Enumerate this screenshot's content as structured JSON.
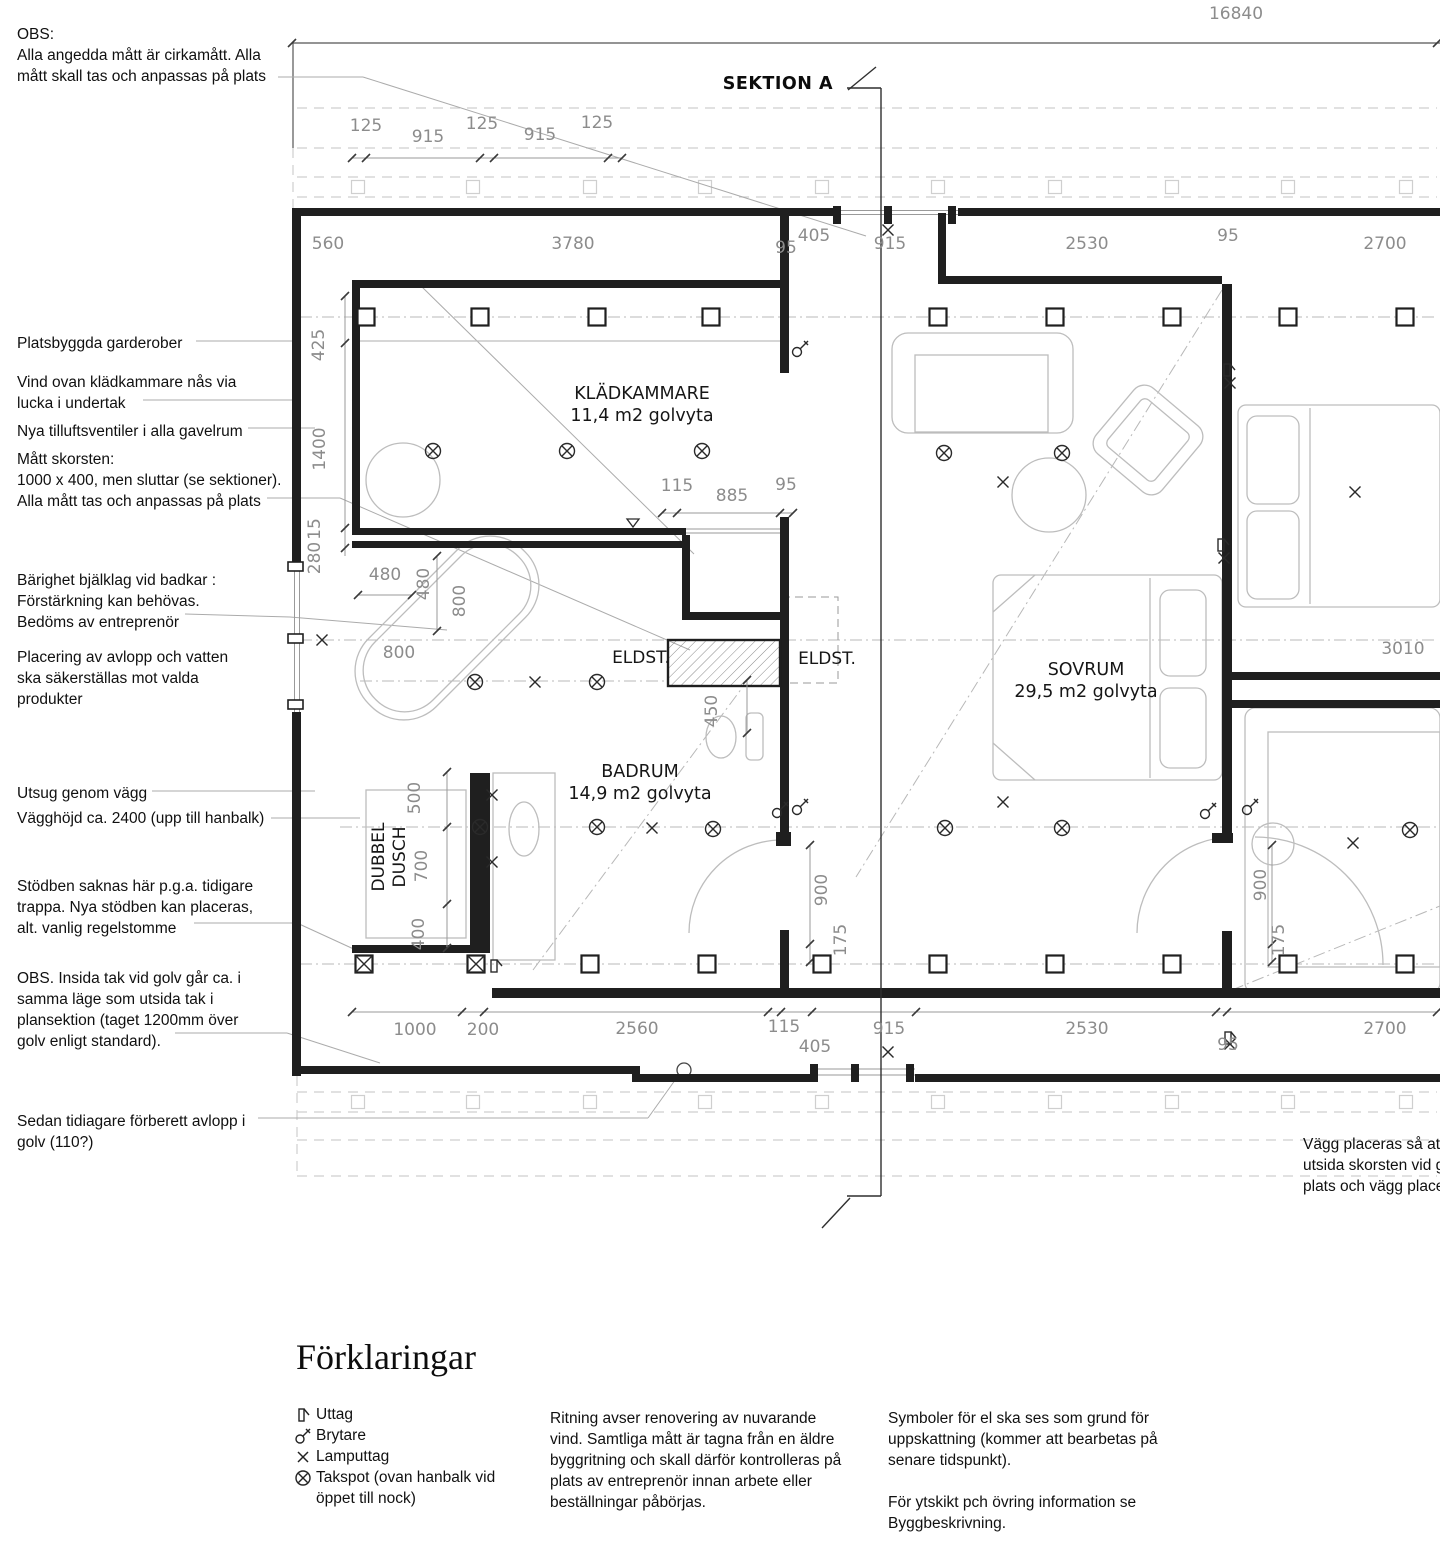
{
  "section": {
    "label": "SEKTION A"
  },
  "rooms": [
    {
      "name": "KLÄDKAMMARE",
      "area": "11,4 m2 golvyta",
      "x": 642,
      "y": 399
    },
    {
      "name": "BADRUM",
      "area": "14,9 m2 golvyta",
      "x": 640,
      "y": 777
    },
    {
      "name": "SOVRUM",
      "area": "29,5 m2 golvyta",
      "x": 1086,
      "y": 675
    }
  ],
  "plan_labels": [
    {
      "text": "ELDST.",
      "x": 641,
      "y": 663
    },
    {
      "text": "ELDST.",
      "x": 827,
      "y": 664
    },
    {
      "text": "DUBBEL",
      "x": 384,
      "y": 857,
      "rot": -90
    },
    {
      "text": "DUSCH",
      "x": 405,
      "y": 857,
      "rot": -90
    }
  ],
  "dimensions": [
    {
      "t": "16840",
      "x": 1236,
      "y": 19
    },
    {
      "t": "125",
      "x": 366,
      "y": 131
    },
    {
      "t": "915",
      "x": 428,
      "y": 142
    },
    {
      "t": "125",
      "x": 482,
      "y": 129
    },
    {
      "t": "915",
      "x": 540,
      "y": 140
    },
    {
      "t": "125",
      "x": 597,
      "y": 128
    },
    {
      "t": "560",
      "x": 328,
      "y": 249
    },
    {
      "t": "3780",
      "x": 573,
      "y": 249
    },
    {
      "t": "95",
      "x": 786,
      "y": 253
    },
    {
      "t": "405",
      "x": 814,
      "y": 241
    },
    {
      "t": "915",
      "x": 890,
      "y": 249
    },
    {
      "t": "2530",
      "x": 1087,
      "y": 249
    },
    {
      "t": "95",
      "x": 1228,
      "y": 241
    },
    {
      "t": "2700",
      "x": 1385,
      "y": 249
    },
    {
      "t": "425",
      "x": 324,
      "y": 345,
      "rot": -90
    },
    {
      "t": "1400",
      "x": 325,
      "y": 449,
      "rot": -90
    },
    {
      "t": "15",
      "x": 320,
      "y": 529,
      "rot": -90
    },
    {
      "t": "280",
      "x": 320,
      "y": 558,
      "rot": -90
    },
    {
      "t": "115",
      "x": 677,
      "y": 491
    },
    {
      "t": "885",
      "x": 732,
      "y": 501
    },
    {
      "t": "95",
      "x": 786,
      "y": 490
    },
    {
      "t": "480",
      "x": 385,
      "y": 580
    },
    {
      "t": "480",
      "x": 429,
      "y": 584,
      "rot": -90
    },
    {
      "t": "800",
      "x": 465,
      "y": 601,
      "rot": -90
    },
    {
      "t": "800",
      "x": 399,
      "y": 658
    },
    {
      "t": "500",
      "x": 420,
      "y": 798,
      "rot": -90
    },
    {
      "t": "700",
      "x": 427,
      "y": 866,
      "rot": -90
    },
    {
      "t": "400",
      "x": 424,
      "y": 934,
      "rot": -90
    },
    {
      "t": "450",
      "x": 717,
      "y": 711,
      "rot": -90
    },
    {
      "t": "900",
      "x": 827,
      "y": 890,
      "rot": -90
    },
    {
      "t": "175",
      "x": 846,
      "y": 940,
      "rot": -90
    },
    {
      "t": "900",
      "x": 1266,
      "y": 885,
      "rot": -90
    },
    {
      "t": "175",
      "x": 1284,
      "y": 940,
      "rot": -90
    },
    {
      "t": "3010",
      "x": 1403,
      "y": 654
    },
    {
      "t": "1000",
      "x": 415,
      "y": 1035
    },
    {
      "t": "200",
      "x": 483,
      "y": 1035
    },
    {
      "t": "2560",
      "x": 637,
      "y": 1034
    },
    {
      "t": "115",
      "x": 784,
      "y": 1032
    },
    {
      "t": "405",
      "x": 815,
      "y": 1052
    },
    {
      "t": "915",
      "x": 889,
      "y": 1034
    },
    {
      "t": "2530",
      "x": 1087,
      "y": 1034
    },
    {
      "t": "95",
      "x": 1228,
      "y": 1050
    },
    {
      "t": "2700",
      "x": 1385,
      "y": 1034
    }
  ],
  "annotations_left": [
    {
      "x": 17,
      "y": 24,
      "lines": [
        "OBS:",
        "Alla angedda mått är cirkamått. Alla",
        "mått skall tas och anpassas på plats"
      ]
    },
    {
      "x": 17,
      "y": 333,
      "lines": [
        "Platsbyggda garderober"
      ]
    },
    {
      "x": 17,
      "y": 372,
      "lines": [
        "Vind ovan klädkammare nås via",
        "lucka i undertak"
      ]
    },
    {
      "x": 17,
      "y": 421,
      "lines": [
        "Nya tilluftsventiler i alla gavelrum"
      ]
    },
    {
      "x": 17,
      "y": 449,
      "lines": [
        "Mått skorsten:",
        "1000 x 400, men sluttar (se sektioner).",
        "Alla mått tas och anpassas på plats"
      ]
    },
    {
      "x": 17,
      "y": 570,
      "lines": [
        "Bärighet bjälklag vid badkar :",
        "Förstärkning kan behövas.",
        "Bedöms av entreprenör"
      ]
    },
    {
      "x": 17,
      "y": 647,
      "lines": [
        "Placering av avlopp och vatten",
        "ska säkerställas mot valda",
        "produkter"
      ]
    },
    {
      "x": 17,
      "y": 783,
      "lines": [
        "Utsug genom vägg"
      ]
    },
    {
      "x": 17,
      "y": 808,
      "lines": [
        "Vägghöjd ca. 2400 (upp till hanbalk)"
      ]
    },
    {
      "x": 17,
      "y": 876,
      "lines": [
        "Stödben saknas här p.g.a. tidigare",
        "trappa. Nya stödben kan placeras,",
        "alt. vanlig regelstomme"
      ]
    },
    {
      "x": 17,
      "y": 968,
      "lines": [
        "OBS. Insida tak vid golv går ca. i",
        "samma läge som utsida tak i",
        "plansektion (taget 1200mm över",
        "golv enligt standard)."
      ]
    },
    {
      "x": 17,
      "y": 1111,
      "lines": [
        "Sedan tidiagare förberett avlopp i",
        "golv (110?)"
      ]
    }
  ],
  "note_right": {
    "x": 1303,
    "y": 1134,
    "lines": [
      "Vägg placeras så at",
      "utsida skorsten vid g",
      "plats och vägg place"
    ]
  },
  "legend": {
    "title": "Förklaringar",
    "items": [
      {
        "icon": "uttag-icon",
        "label": "Uttag"
      },
      {
        "icon": "brytare-icon",
        "label": "Brytare"
      },
      {
        "icon": "lamputtag-icon",
        "label": "Lamputtag"
      },
      {
        "icon": "takspot-icon",
        "label": "Takspot (ovan hanbalk vid",
        "label2": "öppet till nock)"
      }
    ]
  },
  "notes": [
    {
      "x": 550,
      "y": 1408,
      "lines": [
        "Ritning avser renovering av nuvarande",
        "vind. Samtliga mått är tagna från en äldre",
        "byggritning och skall därför kontrolleras på",
        "plats av entreprenör innan arbete eller",
        "beställningar påbörjas."
      ]
    },
    {
      "x": 888,
      "y": 1408,
      "lines": [
        "Symboler för el ska ses som grund för",
        "uppskattning (kommer att bearbetas på",
        "senare tidspunkt).",
        "",
        "För ytskikt pch övring information se",
        "Byggbeskrivning."
      ]
    }
  ],
  "symbols": {
    "takspot": [
      [
        433,
        451
      ],
      [
        567,
        451
      ],
      [
        702,
        451
      ],
      [
        944,
        453
      ],
      [
        1062,
        453
      ],
      [
        475,
        682
      ],
      [
        597,
        682
      ],
      [
        480,
        827
      ],
      [
        597,
        827
      ],
      [
        713,
        829
      ],
      [
        945,
        828
      ],
      [
        1062,
        828
      ],
      [
        1410,
        830
      ]
    ],
    "lamputtag": [
      [
        888,
        230
      ],
      [
        322,
        640
      ],
      [
        535,
        682
      ],
      [
        652,
        828
      ],
      [
        1003,
        482
      ],
      [
        1003,
        802
      ],
      [
        888,
        1052
      ],
      [
        1355,
        492
      ],
      [
        1353,
        843
      ],
      [
        1230,
        383
      ],
      [
        1224,
        558
      ],
      [
        1230,
        1044
      ],
      [
        492,
        795
      ],
      [
        492,
        862
      ]
    ],
    "brytare": [
      [
        797,
        352
      ],
      [
        777,
        813
      ],
      [
        797,
        810
      ],
      [
        1205,
        814
      ],
      [
        1247,
        810
      ]
    ],
    "uttag": [
      [
        1227,
        370
      ],
      [
        1221,
        545
      ],
      [
        1228,
        1038
      ],
      [
        494,
        966
      ]
    ],
    "columns": [
      [
        366,
        317
      ],
      [
        480,
        317
      ],
      [
        597,
        317
      ],
      [
        711,
        317
      ],
      [
        938,
        317
      ],
      [
        1055,
        317
      ],
      [
        1172,
        317
      ],
      [
        1288,
        317
      ],
      [
        1405,
        317
      ],
      [
        590,
        964
      ],
      [
        707,
        964
      ],
      [
        822,
        964
      ],
      [
        938,
        964
      ],
      [
        1055,
        964
      ],
      [
        1172,
        964
      ],
      [
        1288,
        964
      ],
      [
        1405,
        964
      ]
    ],
    "columns_hatched": [
      [
        364,
        964
      ],
      [
        476,
        964
      ]
    ],
    "band_squares_x": [
      358,
      473,
      590,
      705,
      822,
      938,
      1055,
      1172,
      1288,
      1406
    ],
    "band_squares_y": [
      187,
      1102
    ]
  },
  "colors": {
    "wall": "#1f1f1f",
    "dim_text": "#8c8c8c",
    "furniture": "#bdbdbd",
    "leader": "#ababab"
  }
}
